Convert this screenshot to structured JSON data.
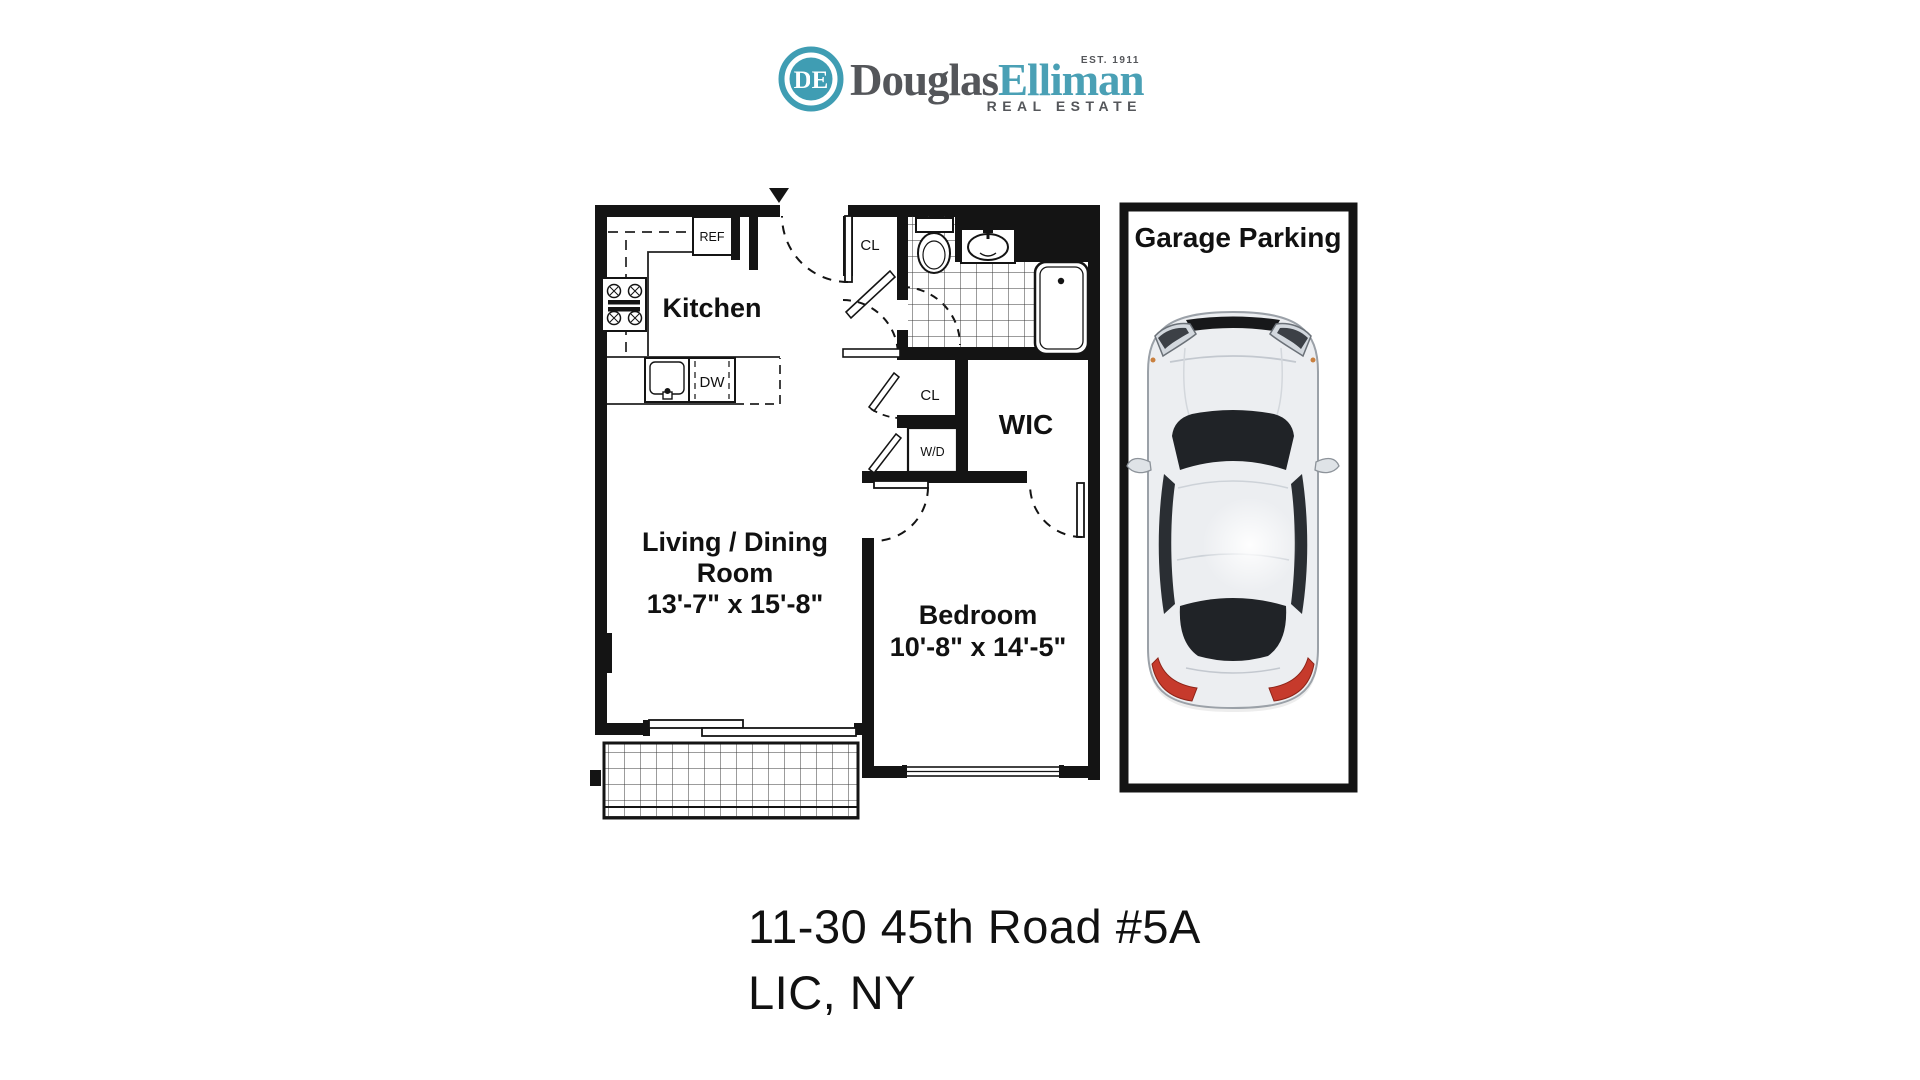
{
  "brand": {
    "monogram": "DE",
    "name_part1": "Douglas",
    "name_part2": "Elliman",
    "established": "EST. 1911",
    "division": "REAL ESTATE",
    "teal": "#3F9DB3",
    "gray": "#54565A"
  },
  "floorplan": {
    "kitchen": {
      "label": "Kitchen",
      "ref": "REF",
      "dw": "DW"
    },
    "closets": {
      "cl_top": "CL",
      "cl_mid": "CL",
      "wd": "W/D",
      "wic": "WIC"
    },
    "living": {
      "line1": "Living / Dining",
      "line2": "Room",
      "dims": "13'-7\" x 15'-8\""
    },
    "bedroom": {
      "label": "Bedroom",
      "dims": "10'-8\" x 14'-5\""
    }
  },
  "garage": {
    "title": "Garage Parking"
  },
  "address": {
    "line1": "11-30 45th Road #5A",
    "line2": "LIC, NY"
  }
}
